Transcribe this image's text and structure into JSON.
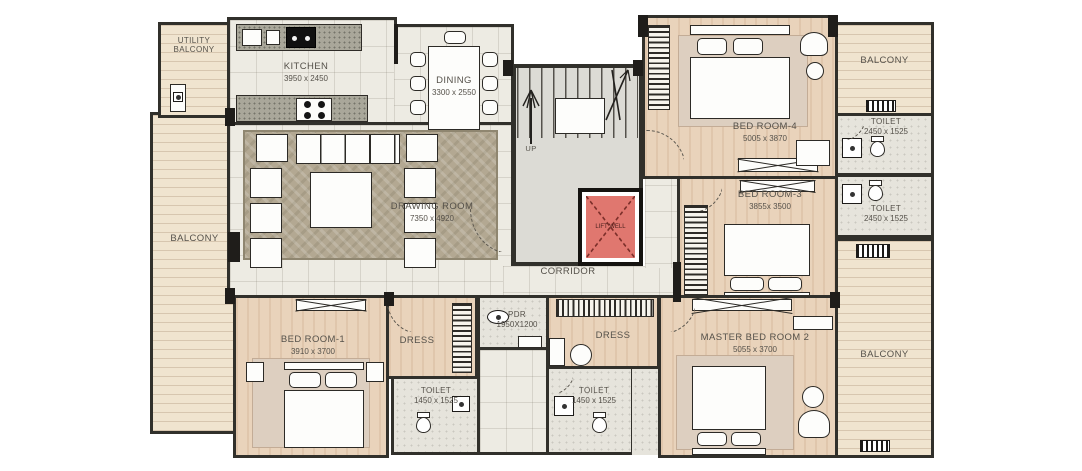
{
  "plan_type": "apartment-floor-plan",
  "rooms": {
    "utility_balcony": {
      "label": "UTILITY",
      "label2": "BALCONY"
    },
    "kitchen": {
      "label": "KITCHEN",
      "dims": "3950 x 2450"
    },
    "dining": {
      "label": "DINING",
      "dims": "3300 x 2550"
    },
    "drawing_room": {
      "label": "DRAWING ROOM",
      "dims": "7350 x 4920"
    },
    "balcony_left": {
      "label": "BALCONY"
    },
    "stairs": {
      "label": "UP"
    },
    "lift_well": {
      "label": "LIFT WELL"
    },
    "corridor": {
      "label": "CORRIDOR"
    },
    "bedroom4": {
      "label": "BED ROOM-4",
      "dims": "5005 x 3870"
    },
    "balcony_top_right": {
      "label": "BALCONY"
    },
    "toilet_tr": {
      "label": "TOILET",
      "dims": "2450 x 1525"
    },
    "toilet_mr": {
      "label": "TOILET",
      "dims": "2450 x 1525"
    },
    "bedroom3": {
      "label": "BED ROOM-3",
      "dims": "3855x 3500"
    },
    "bedroom1": {
      "label": "BED ROOM-1",
      "dims": "3910 x 3700"
    },
    "dress1": {
      "label": "DRESS"
    },
    "toilet1": {
      "label": "TOILET",
      "dims": "1450 x 1525"
    },
    "pdr": {
      "label": "PDR",
      "dims": "1950X1200"
    },
    "dress2": {
      "label": "DRESS"
    },
    "toilet2": {
      "label": "TOILET",
      "dims": "1450 x 1525"
    },
    "master_bedroom": {
      "label": "MASTER BED ROOM 2",
      "dims": "5055 x 3700"
    },
    "balcony_bottom_right": {
      "label": "BALCONY"
    }
  },
  "colors": {
    "wall": "#31302b",
    "tile_floor": "#edebe3",
    "wood_floor": "#e9d3bb",
    "balcony_floor": "#f0e4cf",
    "bath_floor": "#e6e4dc",
    "carpet": "#b3a892",
    "lift_well": "#e0776f"
  }
}
